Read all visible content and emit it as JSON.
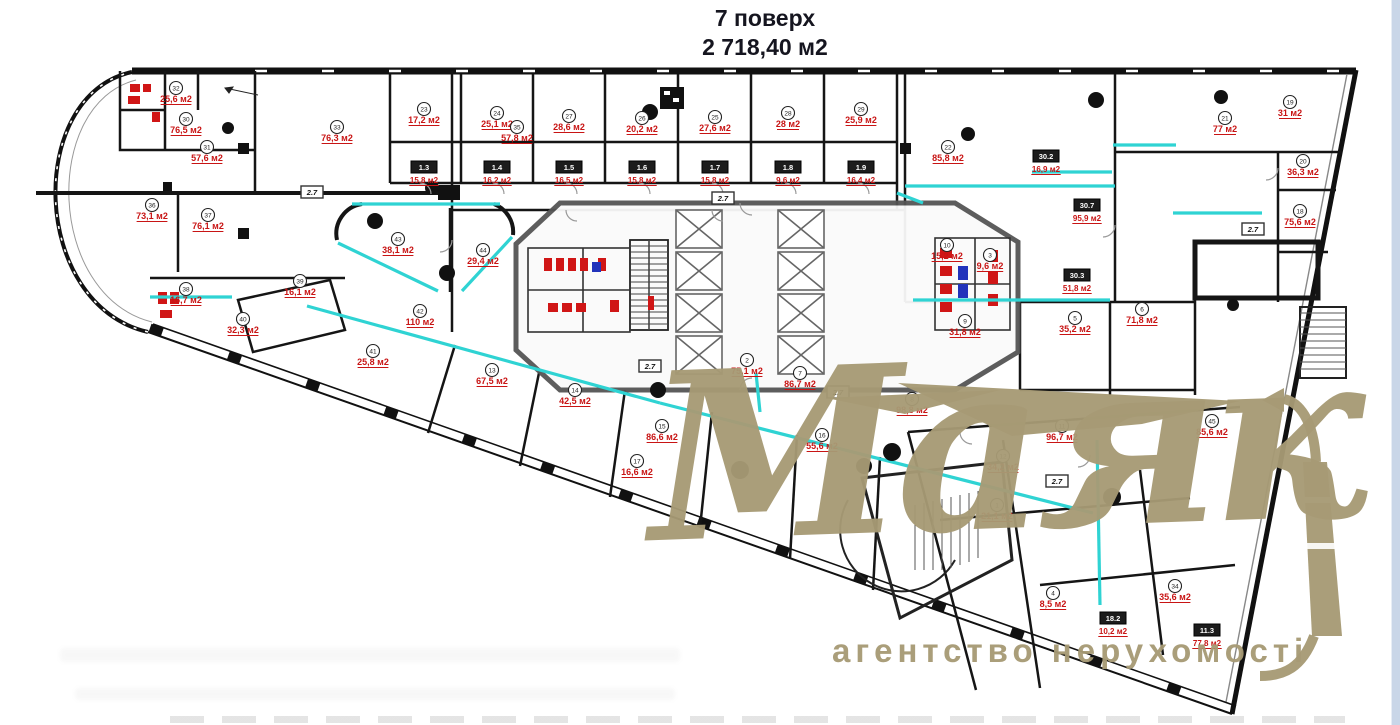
{
  "title": {
    "line1": "7 поверх",
    "line2": "2 718,40 м2"
  },
  "watermark": {
    "brand": "Маяк",
    "tagline": "агентство нерухомості",
    "color": "#a79a75"
  },
  "colors": {
    "wall": "#151515",
    "core_wall": "#555555",
    "partition_teal": "#2fd3d3",
    "area_label_red": "#c81414",
    "fixture_red": "#d01616",
    "fixture_blue": "#2233bb",
    "edge_strip_blue": "#c9d6e8"
  },
  "rooms": [
    {
      "num": "1",
      "area": "21,1 м2",
      "x": 997,
      "y": 516
    },
    {
      "num": "2",
      "area": "75,1 м2",
      "x": 747,
      "y": 371
    },
    {
      "num": "3",
      "area": "9,6 м2",
      "x": 990,
      "y": 266
    },
    {
      "num": "4",
      "area": "8,5 м2",
      "x": 1053,
      "y": 604
    },
    {
      "num": "5",
      "area": "35,2 м2",
      "x": 1075,
      "y": 329
    },
    {
      "num": "6",
      "area": "71,8 м2",
      "x": 1142,
      "y": 320
    },
    {
      "num": "7",
      "area": "86,7 м2",
      "x": 800,
      "y": 384
    },
    {
      "num": "8",
      "area": "98,8 м2",
      "x": 912,
      "y": 410
    },
    {
      "num": "9",
      "area": "31,8 м2",
      "x": 965,
      "y": 332
    },
    {
      "num": "10",
      "area": "15,2 м2",
      "x": 947,
      "y": 256
    },
    {
      "num": "11",
      "area": "96,7 м2",
      "x": 1062,
      "y": 437
    },
    {
      "num": "12",
      "area": "34,2 м2",
      "x": 1003,
      "y": 467
    },
    {
      "num": "13",
      "area": "67,5 м2",
      "x": 492,
      "y": 381
    },
    {
      "num": "14",
      "area": "42,5 м2",
      "x": 575,
      "y": 401
    },
    {
      "num": "15",
      "area": "86,6 м2",
      "x": 662,
      "y": 437
    },
    {
      "num": "16",
      "area": "55,6 м2",
      "x": 822,
      "y": 446
    },
    {
      "num": "17",
      "area": "16,6 м2",
      "x": 637,
      "y": 472
    },
    {
      "num": "18",
      "area": "75,6 м2",
      "x": 1300,
      "y": 222
    },
    {
      "num": "19",
      "area": "31 м2",
      "x": 1290,
      "y": 113
    },
    {
      "num": "20",
      "area": "36,3 м2",
      "x": 1303,
      "y": 172
    },
    {
      "num": "21",
      "area": "77 м2",
      "x": 1225,
      "y": 129
    },
    {
      "num": "22",
      "area": "85,8 м2",
      "x": 948,
      "y": 158
    },
    {
      "num": "23",
      "area": "17,2 м2",
      "x": 424,
      "y": 120
    },
    {
      "num": "24",
      "area": "25,1 м2",
      "x": 497,
      "y": 124
    },
    {
      "num": "25",
      "area": "27,6 м2",
      "x": 715,
      "y": 128
    },
    {
      "num": "26",
      "area": "20,2 м2",
      "x": 642,
      "y": 129
    },
    {
      "num": "27",
      "area": "28,6 м2",
      "x": 569,
      "y": 127
    },
    {
      "num": "28",
      "area": "28 м2",
      "x": 788,
      "y": 124
    },
    {
      "num": "29",
      "area": "25,9 м2",
      "x": 861,
      "y": 120
    },
    {
      "num": "30",
      "area": "76,5 м2",
      "x": 186,
      "y": 130
    },
    {
      "num": "31",
      "area": "57,6 м2",
      "x": 207,
      "y": 158
    },
    {
      "num": "32",
      "area": "25,6 м2",
      "x": 176,
      "y": 99
    },
    {
      "num": "33",
      "area": "76,3 м2",
      "x": 337,
      "y": 138
    },
    {
      "num": "34",
      "area": "35,6 м2",
      "x": 1175,
      "y": 597
    },
    {
      "num": "35",
      "area": "57,8 м2",
      "x": 517,
      "y": 138
    },
    {
      "num": "36",
      "area": "73,1 м2",
      "x": 152,
      "y": 216
    },
    {
      "num": "37",
      "area": "76,1 м2",
      "x": 208,
      "y": 226
    },
    {
      "num": "38",
      "area": "16,7 м2",
      "x": 186,
      "y": 300
    },
    {
      "num": "39",
      "area": "16,1 м2",
      "x": 300,
      "y": 292
    },
    {
      "num": "40",
      "area": "32,3 м2",
      "x": 243,
      "y": 330
    },
    {
      "num": "41",
      "area": "25,8 м2",
      "x": 373,
      "y": 362
    },
    {
      "num": "42",
      "area": "110 м2",
      "x": 420,
      "y": 322
    },
    {
      "num": "43",
      "area": "38,1 м2",
      "x": 398,
      "y": 250
    },
    {
      "num": "44",
      "area": "29,4 м2",
      "x": 483,
      "y": 261
    },
    {
      "num": "45",
      "area": "85,6 м2",
      "x": 1212,
      "y": 432
    }
  ],
  "plaques": [
    {
      "label": "1.3",
      "x": 424,
      "y": 167,
      "area": "15,8 м2"
    },
    {
      "label": "1.4",
      "x": 497,
      "y": 167,
      "area": "16,2 м2"
    },
    {
      "label": "1.5",
      "x": 569,
      "y": 167,
      "area": "16,5 м2"
    },
    {
      "label": "1.6",
      "x": 642,
      "y": 167,
      "area": "15,8 м2"
    },
    {
      "label": "1.7",
      "x": 715,
      "y": 167,
      "area": "15,8 м2"
    },
    {
      "label": "1.8",
      "x": 788,
      "y": 167,
      "area": "9,6 м2"
    },
    {
      "label": "1.9",
      "x": 861,
      "y": 167,
      "area": "16,4 м2"
    },
    {
      "label": "30.2",
      "x": 1046,
      "y": 156,
      "area": "16,9 м2"
    },
    {
      "label": "30.7",
      "x": 1087,
      "y": 205,
      "area": "95,9 м2"
    },
    {
      "label": "30.3",
      "x": 1077,
      "y": 275,
      "area": "51,8 м2"
    },
    {
      "label": "18.2",
      "x": 1113,
      "y": 618,
      "area": "10,2 м2"
    },
    {
      "label": "11.3",
      "x": 1207,
      "y": 630,
      "area": "77,8 м2"
    }
  ],
  "corridor_markers": [
    {
      "label": "2.7",
      "x": 312,
      "y": 192
    },
    {
      "label": "2.7",
      "x": 723,
      "y": 198
    },
    {
      "label": "2.7",
      "x": 650,
      "y": 366
    },
    {
      "label": "2.7",
      "x": 838,
      "y": 392
    },
    {
      "label": "2.7",
      "x": 1057,
      "y": 481
    },
    {
      "label": "2.7",
      "x": 1253,
      "y": 229
    }
  ]
}
